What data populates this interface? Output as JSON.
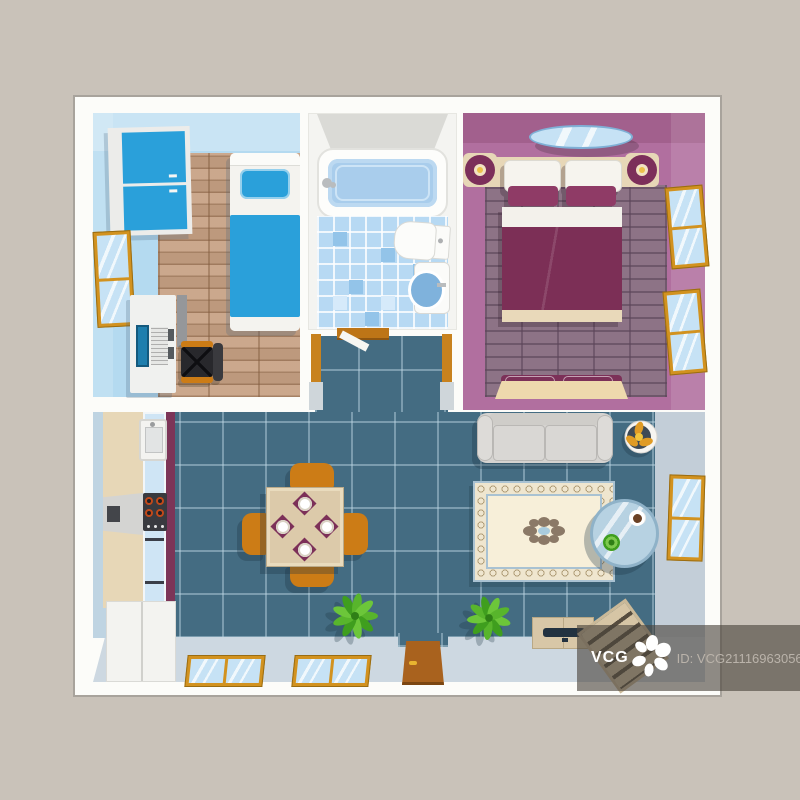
{
  "image_type": "apartment-floor-plan-top-view-illustration",
  "watermark": {
    "brand": "VCG",
    "id_text": "ID: VCG211169630560",
    "logo": "vcg-flower-logo"
  },
  "palette": {
    "bg": "#c9c2b9",
    "card": "#fcfcf9",
    "cardBorder": "#a8a39c",
    "blueWall": "#b4daf0",
    "wood": "#c7a184",
    "furnBlue": "#2aa0da",
    "bathFloor": "#b7d9f3",
    "water": "#a9cdec",
    "mauve": "#b16f9f",
    "brick": "#8d7386",
    "maroon": "#7c2f56",
    "cream": "#e7d7b7",
    "teal": "#446c82",
    "balcony": "#cdd8e1",
    "rightwall": "#c3ced8",
    "orange": "#cc7c16",
    "gold": "#d2921f",
    "glass": "#c6e2f5",
    "sofa": "#d5d3d0",
    "rugField": "#f7efd9",
    "rugBand": "#efe6cf",
    "green": "#4fae22",
    "wmBand": "rgba(74,68,60,0.62)",
    "wmId": "#bab3aa"
  },
  "plan": {
    "rooms": [
      {
        "name": "bedroom-study",
        "wall_color": "#b4daf0",
        "floor": "wood-planks",
        "furniture": [
          "wardrobe",
          "single-bed",
          "window",
          "desk",
          "laptop",
          "office-chair",
          "side-cabinet"
        ]
      },
      {
        "name": "bathroom",
        "floor": "blue-checker-tile",
        "furniture": [
          "bathtub",
          "toilet",
          "wash-basin"
        ]
      },
      {
        "name": "entrance-hall",
        "floor": "teal-tile",
        "furniture": [
          "door-threshold",
          "door-leaf"
        ]
      },
      {
        "name": "master-bedroom",
        "wall_color": "#b16f9f",
        "floor": "purple-brick",
        "furniture": [
          "ceiling-lamp",
          "headboard",
          "nightstand-left",
          "nightstand-right",
          "double-bed",
          "foot-bench",
          "window-upper",
          "window-lower"
        ]
      },
      {
        "name": "living-room-kitchen",
        "floor": "teal-tile",
        "furniture": [
          "kitchen-counter",
          "kitchen-sink",
          "cooker-hood",
          "stove",
          "lower-cabinet",
          "dining-table",
          "dining-chairs-x4",
          "place-settings-x4",
          "sofa",
          "table-fan",
          "rug",
          "coffee-table",
          "coffee-cup",
          "potted-plant-1",
          "potted-plant-2",
          "tv-cabinet",
          "stairs",
          "balcony-window-1",
          "balcony-window-2",
          "wall-window",
          "entrance-door"
        ]
      }
    ]
  }
}
